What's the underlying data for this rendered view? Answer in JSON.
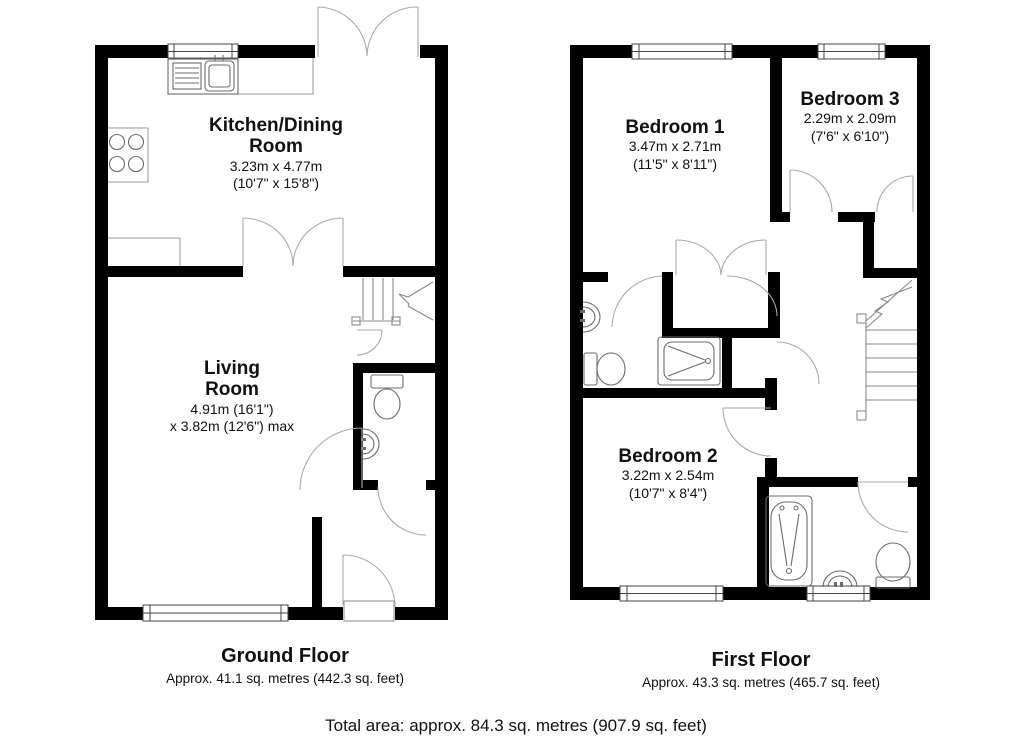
{
  "page": {
    "background": "#ffffff",
    "wall_color": "#000000",
    "accent": "#aaaaaa"
  },
  "ground_floor": {
    "title": "Ground Floor",
    "area": "Approx. 41.1 sq. metres (442.3 sq. feet)",
    "rooms": [
      {
        "name": "Kitchen/Dining\nRoom",
        "size_metric": "3.23m x 4.77m",
        "size_imperial": "(10'7\" x 15'8\")"
      },
      {
        "name": "Living\nRoom",
        "size_metric": "4.91m (16'1\")",
        "size_imperial": "x 3.82m (12'6\") max"
      }
    ]
  },
  "first_floor": {
    "title": "First Floor",
    "area": "Approx. 43.3 sq. metres (465.7 sq. feet)",
    "rooms": [
      {
        "name": "Bedroom 1",
        "size_metric": "3.47m x 2.71m",
        "size_imperial": "(11'5\" x 8'11\")"
      },
      {
        "name": "Bedroom 3",
        "size_metric": "2.29m x 2.09m",
        "size_imperial": "(7'6\" x 6'10\")"
      },
      {
        "name": "Bedroom 2",
        "size_metric": "3.22m x 2.54m",
        "size_imperial": "(10'7\" x 8'4\")"
      }
    ]
  },
  "total_area": "Total area: approx. 84.3 sq. metres (907.9 sq. feet)"
}
